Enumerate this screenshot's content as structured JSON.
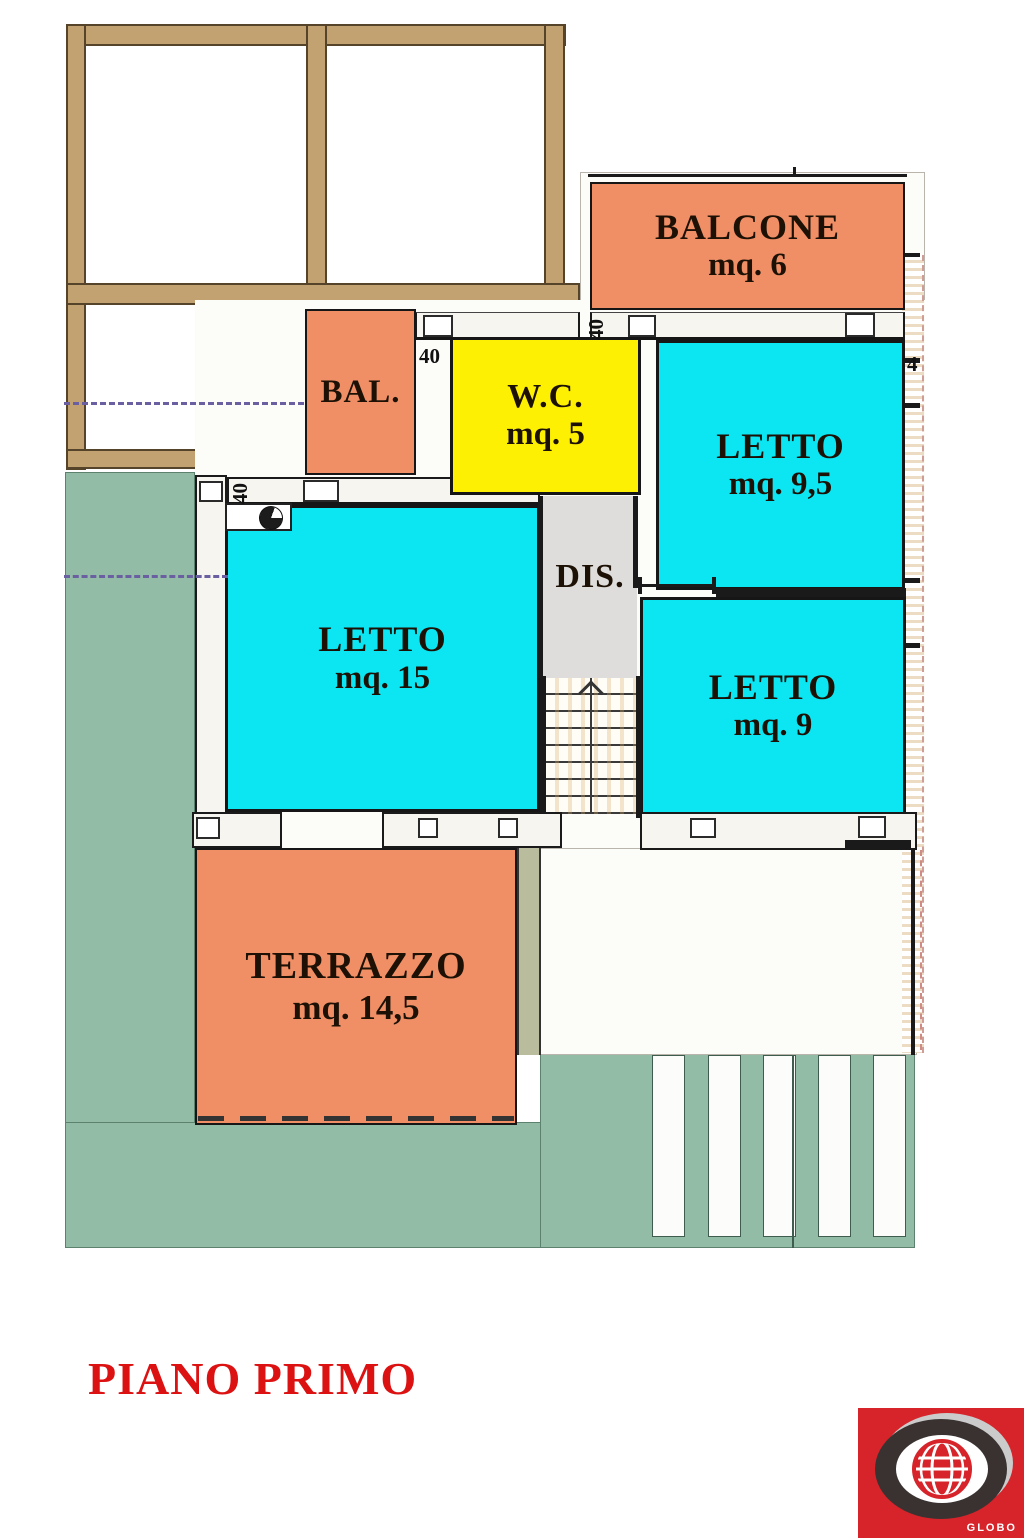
{
  "floor_plan": {
    "title": "PIANO PRIMO",
    "rooms": {
      "balcone": {
        "name": "BALCONE",
        "area": "mq. 6"
      },
      "bal": {
        "name": "BAL."
      },
      "wc": {
        "name": "W.C.",
        "area": "mq. 5"
      },
      "letto_9_5": {
        "name": "LETTO",
        "area": "mq. 9,5"
      },
      "dis": {
        "name": "DIS."
      },
      "letto_15": {
        "name": "LETTO",
        "area": "mq. 15"
      },
      "letto_9": {
        "name": "LETTO",
        "area": "mq. 9"
      },
      "terrazzo": {
        "name": "TERRAZZO",
        "area": "mq. 14,5"
      }
    },
    "dimension_labels": {
      "above_wc": "40",
      "left_of_wc": "40",
      "top_of_letto_15": "40",
      "right_wall": "4"
    },
    "colors": {
      "balcony_terrace": "#f08f66",
      "bedroom": "#0ce6f2",
      "wc": "#fdf002",
      "hallway": "#dedddb",
      "garden": "#93bca6",
      "pergola_wood": "#c2a270",
      "title_red": "#dc1212"
    },
    "logo": {
      "brand": "GLOBO"
    }
  }
}
